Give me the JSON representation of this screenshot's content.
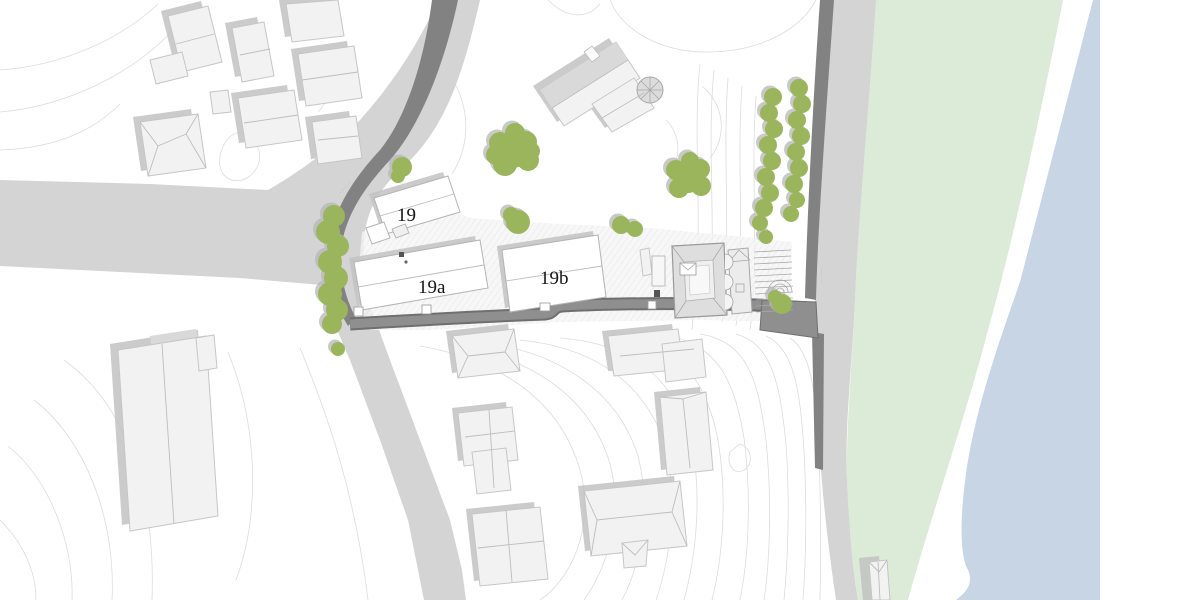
{
  "plan": {
    "building_labels": [
      {
        "id": "building-19",
        "text": "19"
      },
      {
        "id": "building-19a",
        "text": "19a"
      },
      {
        "id": "building-19b",
        "text": "19b"
      }
    ],
    "street_labels": [
      {
        "id": "street-left",
        "text": "·······"
      },
      {
        "id": "street-right",
        "text": "·······"
      }
    ],
    "colors": {
      "tree": "#9ab55c",
      "tree_shadow": "#b7b7b7",
      "park": "#dcead8",
      "water": "#c7d5e5",
      "road": "#d4d4d4",
      "lane_dark": "#6f6f6f",
      "lane_light": "#8f8f8f",
      "wall": "#828282",
      "building": "#f2f2f2",
      "highlight_building": "#ffffff",
      "contour": "#dcdcdc",
      "label": "#141414"
    }
  }
}
